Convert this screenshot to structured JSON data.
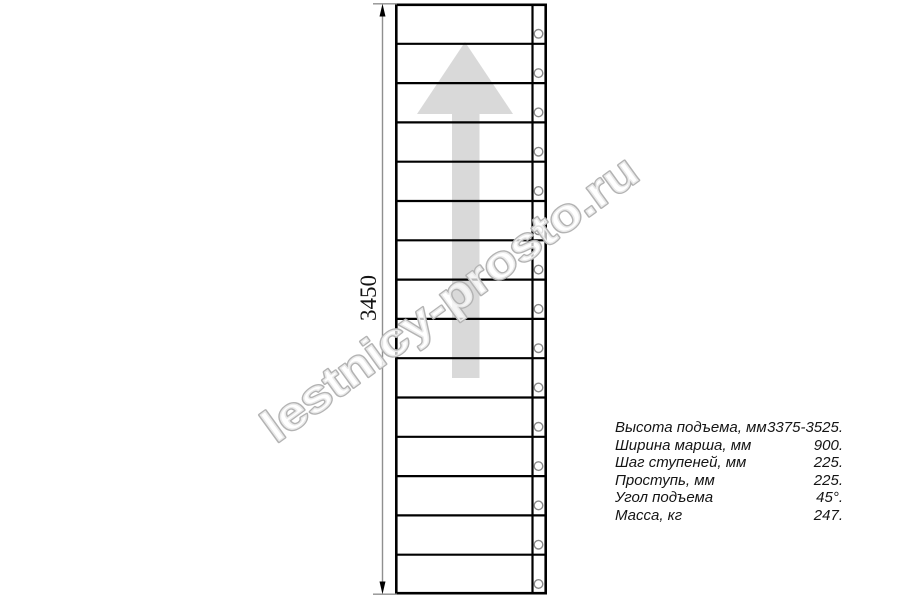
{
  "dimension": {
    "label": "3450"
  },
  "stairs": {
    "step_count": 15,
    "screw_count": 15
  },
  "direction_arrow": {
    "direction": "up"
  },
  "specs": {
    "rows": [
      {
        "label": "Высота подъема, мм",
        "value": "3375-3525."
      },
      {
        "label": "Ширина марша, мм",
        "value": "900."
      },
      {
        "label": "Шаг ступеней, мм",
        "value": "225."
      },
      {
        "label": "Проступь, мм",
        "value": "225."
      },
      {
        "label": "Угол подъема",
        "value": "45°."
      },
      {
        "label": "Масса, кг",
        "value": "247."
      }
    ]
  },
  "watermark": {
    "text": "lestnicy-prosto.ru"
  },
  "colors": {
    "line": "#000000",
    "dimension_line": "#8f8f8f",
    "arrow_fill": "#d9d9d9",
    "watermark_stroke": "#b3b3b3",
    "watermark_fill": "rgba(255,255,255,0.72)",
    "screw_stroke": "#8a8a8a",
    "text": "#141414"
  }
}
